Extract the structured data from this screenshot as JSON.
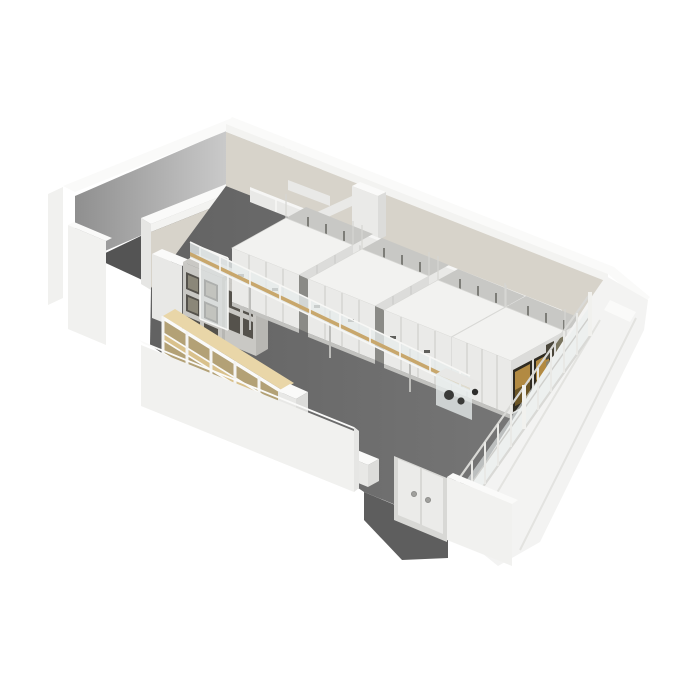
{
  "scene": {
    "kind": "isometric-cutaway-3d-render",
    "room": "art storage hall with mobile shelving",
    "counts": {
      "mobile_storage_units": 4,
      "wood_shelving_bays": 5,
      "wood_shelf_levels": 3,
      "glass_door_cabinets": 2,
      "door_leaves": 2,
      "door_knobs": 2,
      "large_paintings": 2,
      "small_framed_works": 4,
      "wall_vents": 2,
      "fence_bays": 10
    }
  },
  "palette": {
    "background": "#ffffff",
    "floor": "#6b6b6b",
    "floor_back_room": "#545454",
    "vestibule_floor": "#5e5e5e",
    "wall_cap": "#fafaf9",
    "wall_outer": "#f1f1ef",
    "wall_outer_shade": "#e6e6e4",
    "wall_inner_gray": "#b5b5b3",
    "wall_beige": "#d7d3ca",
    "wall_beige_band": "#f3f3f1",
    "right_wall": "#f3f3f2",
    "unit_top": "#f2f2f0",
    "unit_front": "#eaeae8",
    "unit_side": "#dcdcda",
    "unit_base": "#c2c2bf",
    "unit_stripe": "#c8c8c5",
    "aisle_dark": "#8a8a86",
    "handle_dark": "#5f5f5b",
    "duct_body": "#e9e9e7",
    "duct_top": "#f6f6f5",
    "conveyor_glass": "#e7ecec",
    "conveyor_wood": "#c8a76c",
    "lift_glass": "#e4e9e9",
    "cabinet_body": "#c9c8c4",
    "cabinet_side": "#b8b7b3",
    "cabinet_panel": "#55524c",
    "cabinet_panel_inner": "#8b8779",
    "white_cabinet": "#e8e8e6",
    "wood_light": "#e9d6a8",
    "wood_mid": "#d9c18c",
    "wood_shadow": "#b3a176",
    "table_top": "#5a432d",
    "table_front": "#4a3625",
    "table_side": "#3e2d1f",
    "door_leaf": "#ebebe9",
    "door_frame": "#d8d8d5",
    "knob": "#9f9f9c",
    "fence_glass": "#e9eded",
    "painting_frame": "#2f2b22",
    "painting_gold": "#b28a42",
    "painting_gold_dark": "#6b5526",
    "sepia_light": "#8a8672",
    "sepia_mid": "#7a755f",
    "sepia_dark": "#4a463a",
    "vent_dark": "#4b4b48",
    "vent_top": "#73736f",
    "machine_dark": "#3a3a38",
    "wheel_knob": "#2e2e2c"
  }
}
